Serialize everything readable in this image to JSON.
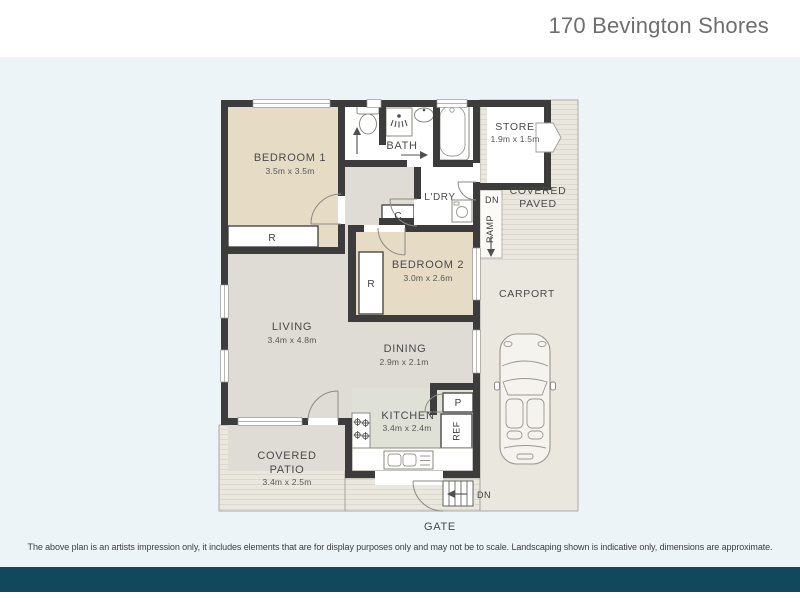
{
  "header": {
    "title": "170 Bevington Shores"
  },
  "floorplan": {
    "rooms": {
      "bedroom1": {
        "name": "BEDROOM 1",
        "dims": "3.5m x 3.5m"
      },
      "bedroom2": {
        "name": "BEDROOM 2",
        "dims": "3.0m x 2.6m"
      },
      "living": {
        "name": "LIVING",
        "dims": "3.4m x 4.8m"
      },
      "dining": {
        "name": "DINING",
        "dims": "2.9m x 2.1m"
      },
      "kitchen": {
        "name": "KITCHEN",
        "dims": "3.4m x 2.4m"
      },
      "bath": {
        "name": "BATH"
      },
      "laundry": {
        "name": "L'DRY"
      },
      "store": {
        "name": "STORE",
        "dims": "1.9m x 1.5m"
      },
      "covered_paved": {
        "line1": "COVERED",
        "line2": "PAVED"
      },
      "carport": {
        "name": "CARPORT"
      },
      "covered_patio": {
        "line1": "COVERED",
        "line2": "PATIO",
        "dims": "3.4m x 2.5m"
      },
      "gate": {
        "name": "GATE"
      }
    },
    "markers": {
      "robe1": "R",
      "robe2": "R",
      "cupboard": "C",
      "pantry": "P",
      "fridge": "REF",
      "ramp": "RAMP",
      "ramp_down": "DN",
      "steps_down": "DN"
    }
  },
  "footer": {
    "disclaimer": "The above plan is an artists impression only, it includes elements that are for display purposes only and may not be to scale. Landscaping shown is indicative only, dimensions are approximate."
  },
  "colors": {
    "accent_bar": "#11485c",
    "background_tint": "#edf4f7",
    "wall": "#3d3c3c",
    "bedroom_fill": "#e6dcc5",
    "floor_fill": "#dedcd5",
    "kitchen_fill": "#dfe1d7",
    "outdoor_fill": "#eae7de"
  }
}
